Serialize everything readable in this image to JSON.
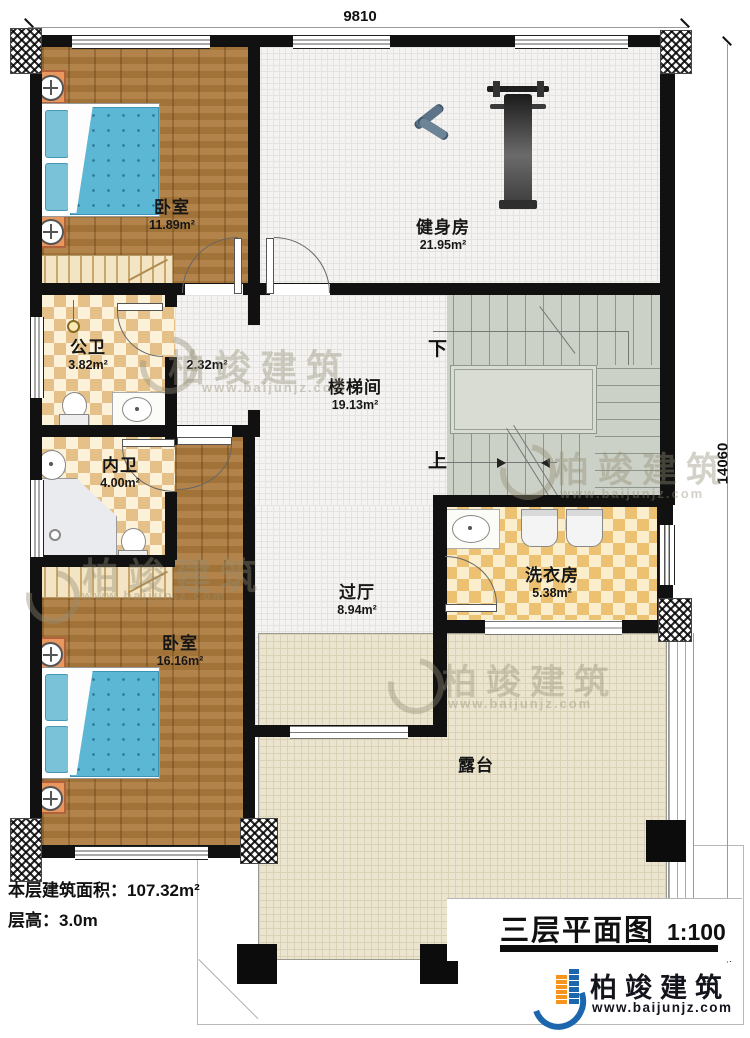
{
  "dimensions": {
    "top": "9810",
    "right": "14060"
  },
  "rooms": {
    "bedroom1": {
      "name": "卧室",
      "area": "11.89m²"
    },
    "gym": {
      "name": "健身房",
      "area": "21.95m²"
    },
    "public_bath": {
      "name": "公卫",
      "area": "3.82m²"
    },
    "corridor": {
      "area": "2.32m²"
    },
    "ensuite_bath": {
      "name": "内卫",
      "area": "4.00m²"
    },
    "stairwell": {
      "name": "楼梯间",
      "area": "19.13m²"
    },
    "hall": {
      "name": "过厅",
      "area": "8.94m²"
    },
    "laundry": {
      "name": "洗衣房",
      "area": "5.38m²"
    },
    "bedroom2": {
      "name": "卧室",
      "area": "16.16m²"
    },
    "terrace": {
      "name": "露台"
    }
  },
  "stairs": {
    "down_label": "下",
    "up_label": "上"
  },
  "footer": {
    "floor_area": "本层建筑面积：107.32m²",
    "floor_height": "层高：3.0m"
  },
  "title_block": {
    "title": "三层平面图",
    "scale": "1:100"
  },
  "brand": {
    "name": "柏竣建筑",
    "website": "www.baijunjz.com"
  },
  "watermark": {
    "name": "柏竣建筑",
    "website": "www.baijunjz.com"
  },
  "colors": {
    "wall": "#111111",
    "wood": "#ab7a3c",
    "terrace": "#ebe5d0",
    "stairs": "#ccd1c7",
    "brand_blue": "#1b66ad",
    "brand_orange": "#f7941d"
  }
}
